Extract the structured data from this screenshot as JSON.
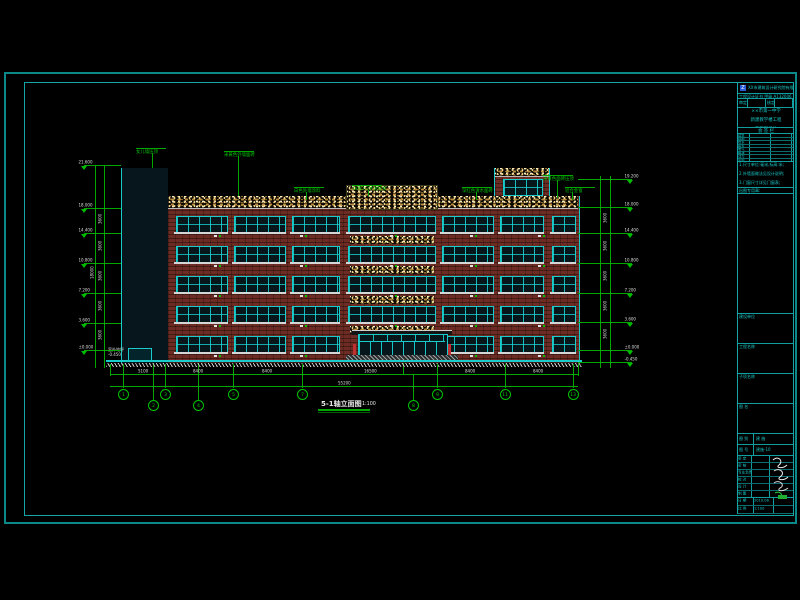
{
  "colors": {
    "frame": "#0b8888",
    "green": "#00b400",
    "cyan": "#19cbcb",
    "brick": "#6d2c23",
    "speckle_tan": "#ecd28f",
    "white": "#dcdcdc",
    "logo_blue": "#2b5cd8",
    "stamp_green": "#1fae2f"
  },
  "drawing": {
    "title": "5-1轴立面图",
    "scale": "1:100",
    "base_note_line1": "室外地坪",
    "base_note_line2": "-0.450",
    "overall_dim": "55200",
    "overall_height": "18000",
    "floor_dims": [
      "3600",
      "3600",
      "3600",
      "3600",
      "3600"
    ],
    "bottom_dims": [
      "5100",
      "8400",
      "8400",
      "16500",
      "8400",
      "8400"
    ],
    "levels_left": [
      {
        "y": 165,
        "v": "21.600"
      },
      {
        "y": 208,
        "v": "18.000"
      },
      {
        "y": 233,
        "v": "14.400"
      },
      {
        "y": 263,
        "v": "10.800"
      },
      {
        "y": 293,
        "v": "7.200"
      },
      {
        "y": 323,
        "v": "3.600"
      },
      {
        "y": 350,
        "v": "±0.000"
      }
    ],
    "levels_right": [
      {
        "y": 179,
        "v": "19.200"
      },
      {
        "y": 207,
        "v": "18.000"
      },
      {
        "y": 233,
        "v": "14.400"
      },
      {
        "y": 263,
        "v": "10.800"
      },
      {
        "y": 293,
        "v": "7.200"
      },
      {
        "y": 322,
        "v": "3.600"
      },
      {
        "y": 350,
        "v": "±0.000"
      },
      {
        "y": 362,
        "v": "-0.450"
      }
    ],
    "grid_bubbles_main": [
      {
        "x": 123,
        "n": "1"
      },
      {
        "x": 165,
        "n": "3"
      },
      {
        "x": 233,
        "n": "5"
      },
      {
        "x": 302,
        "n": "7"
      },
      {
        "x": 437,
        "n": "9"
      },
      {
        "x": 505,
        "n": "11"
      },
      {
        "x": 573,
        "n": "13"
      }
    ],
    "grid_bubbles_drop": [
      {
        "x": 153,
        "n": "2"
      },
      {
        "x": 198,
        "n": "4"
      },
      {
        "x": 413,
        "n": "8"
      }
    ],
    "annotations": [
      {
        "x": 136,
        "y": 147,
        "t": "女儿墙压顶",
        "lx": 152,
        "ly1": 153,
        "ly2": 168
      },
      {
        "x": 224,
        "y": 150,
        "t": "米黄色外墙面砖",
        "lx": 238,
        "ly1": 156,
        "ly2": 196
      },
      {
        "x": 294,
        "y": 186,
        "t": "白色外墙涂料",
        "lx": 306,
        "ly1": 192,
        "ly2": 200
      },
      {
        "x": 352,
        "y": 184,
        "t": "18厚1:2水泥砂浆",
        "lx": 368,
        "ly1": 190,
        "ly2": 196
      },
      {
        "x": 462,
        "y": 186,
        "t": "深红色清水面砖",
        "lx": 476,
        "ly1": 192,
        "ly2": 200
      },
      {
        "x": 543,
        "y": 174,
        "t": "米黄色面砖压顶",
        "lx": 557,
        "ly1": 180,
        "ly2": 198
      },
      {
        "x": 565,
        "y": 186,
        "t": "铝合金窗",
        "lx": 572,
        "ly1": 192,
        "ly2": 200
      }
    ]
  },
  "geometry": {
    "tower": {
      "x": 121,
      "y": 168,
      "w": 46,
      "bottom": 363,
      "bands": [
        [
          0,
          12
        ],
        [
          47,
          8
        ],
        [
          75,
          8
        ],
        [
          103,
          8
        ],
        [
          131,
          8
        ],
        [
          159,
          8
        ]
      ],
      "strip_w": 7
    },
    "body": {
      "x": 167,
      "y": 196,
      "w": 411,
      "bottom": 363,
      "parapet_h": 12
    },
    "center_block": {
      "x": 346,
      "y": 185,
      "w": 90,
      "h": 23
    },
    "penthouse": {
      "x": 494,
      "y": 168,
      "w": 54,
      "h": 28
    },
    "window_rows": [
      216,
      246,
      276,
      306,
      336
    ],
    "window_h": 15,
    "window_groups": [
      [
        176,
        50
      ],
      [
        234,
        50
      ],
      [
        292,
        46
      ],
      [
        348,
        86
      ],
      [
        442,
        50
      ],
      [
        500,
        42
      ],
      [
        552,
        22
      ]
    ],
    "center_group_index": 3,
    "entrance": {
      "x": 358,
      "y": 334,
      "w": 88
    },
    "ground": {
      "x1": 106,
      "x2": 582,
      "y": 360
    },
    "dim_left_x": [
      95,
      104
    ],
    "dim_right_x": [
      600,
      610
    ],
    "bottom_ticks": [
      110,
      123,
      165,
      233,
      302,
      437,
      505,
      573,
      578
    ],
    "dim_line1_y": 374,
    "dim_line2_y": 386,
    "grid_lines_tall": [
      153,
      198,
      403
    ],
    "tag_xs": [
      214,
      300,
      390,
      470,
      538
    ]
  },
  "title_block": {
    "company": "ХХ市建筑设计研究院有限公司",
    "cert": "工程设计证书 甲级 A132006 建设部颁发",
    "approval_cells": [
      "审定",
      "",
      "核定",
      ""
    ],
    "project_lines": [
      "××市第一中学",
      "新建教学楼工程",
      "施工图设计"
    ],
    "sign_title": "会  签  栏",
    "sign_cols": [
      "专业",
      "签名",
      "日期"
    ],
    "sign_row_labels": [
      "建筑",
      "结构",
      "给水",
      "排水",
      "电气",
      "暖通",
      "动力",
      "总图"
    ],
    "notes": [
      "1.尺寸单位:毫米,标高:米;",
      "2.外墙面做法见设计说明;",
      "3.门窗尺寸详见门窗表;",
      "4.未注明者详见设计说明;",
      "5.与各专业图纸配合施工。"
    ],
    "stamp_label": "出图专用章:",
    "boxes": [
      "建设单位",
      "工程名称",
      "子项名称",
      "图    名"
    ],
    "pairs": [
      [
        "图 别",
        "建 施"
      ],
      [
        "图 号",
        "建施-10"
      ]
    ],
    "sig_rows": [
      [
        "审 定",
        ""
      ],
      [
        "审 核",
        ""
      ],
      [
        "专业负责",
        ""
      ],
      [
        "校 对",
        ""
      ],
      [
        "设 计",
        ""
      ],
      [
        "制 图",
        ""
      ]
    ],
    "footer_rows": [
      [
        "日 期",
        "2010.06"
      ],
      [
        "比 例",
        "1:100"
      ]
    ]
  }
}
